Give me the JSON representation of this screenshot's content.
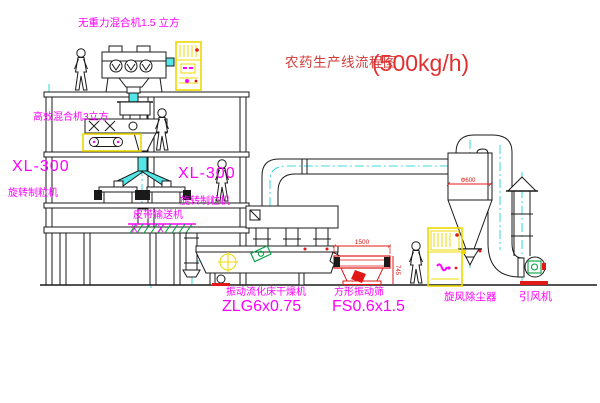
{
  "title": {
    "text": "农药生产线流程图",
    "capacity": "(500kg/h)"
  },
  "equipment": {
    "gravity_mixer": {
      "label": "无重力混合机1.5 立方"
    },
    "high_eff_mixer": {
      "label": "高效混合机3立方"
    },
    "granulator_left": {
      "model": "XL-300",
      "name": "旋转制粒机"
    },
    "granulator_mid": {
      "model": "XL-300",
      "name": "旋转制粒机"
    },
    "belt_conveyor": {
      "name": "皮带输送机"
    },
    "fluid_bed_dryer": {
      "name": "振动流化床干燥机",
      "model": "ZLG6x0.75"
    },
    "vibrating_sieve": {
      "name": "方形振动筛",
      "model": "FS0.6x1.5"
    },
    "cyclone": {
      "name": "旋风除尘器"
    },
    "fan": {
      "name": "引风机"
    }
  },
  "dimensions": {
    "sieve_length": "1500",
    "sieve_height": "745",
    "cyclone_diameter": "Φ600"
  },
  "colors": {
    "line": "#1a1a1a",
    "centerline_cyan": "#00cfcf",
    "chute_fill_cyan": "#54e6e6",
    "label_magenta": "#ff00ff",
    "title_red": "#d43a3a",
    "dimension_red": "#e11818",
    "cabinet_yellow": "#ecd902",
    "motor_green": "#00a040"
  }
}
